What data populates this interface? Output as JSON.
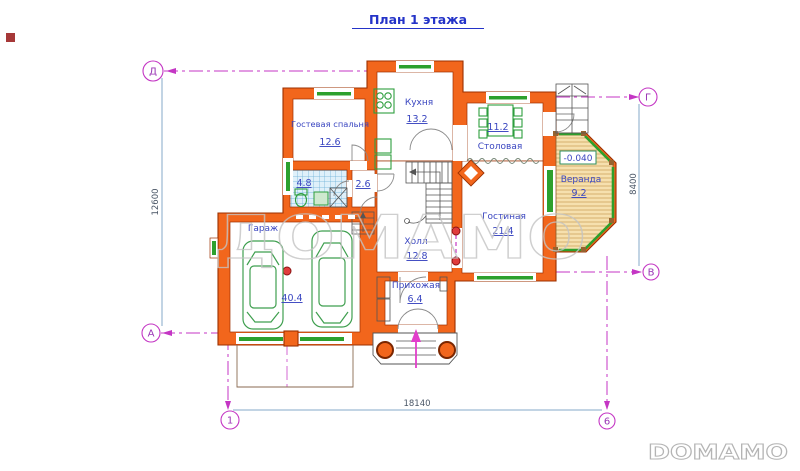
{
  "title": "План 1  этажа",
  "rooms": {
    "bedroom": {
      "name": "Гостевая спальня",
      "area": "12.6"
    },
    "kitchen": {
      "name": "Кухня",
      "area": "13.2"
    },
    "dining": {
      "name": "Столовая",
      "area": "11.2"
    },
    "veranda": {
      "name": "Веранда",
      "area": "9.2",
      "level": "-0.040"
    },
    "living": {
      "name": "Гостиная",
      "area": "21.4"
    },
    "hall": {
      "name": "Холл",
      "area": "12.8"
    },
    "entry": {
      "name": "Прихожая",
      "area": "6.4"
    },
    "garage": {
      "name": "Гараж",
      "area": "40.4"
    },
    "bathroom": {
      "area": "4.8"
    },
    "closet": {
      "area": "2.6"
    }
  },
  "dimensions": {
    "left": "12600",
    "right": "8400",
    "bottom": "18140"
  },
  "axes": {
    "top_left": "Д",
    "top_right": "Г",
    "left_bottom": "А",
    "right_bottom": "В",
    "col_left": "1",
    "col_right": "6"
  },
  "watermark": "ДОМАМО",
  "logo": "DOMAMO",
  "colors": {
    "wall_fill": "#f2661c",
    "wall_outline": "#9c3000",
    "window_green": "#2da02d",
    "label_blue": "#3a46c0",
    "axis_magenta": "#c436c4",
    "dimension_blue": "#85aac8",
    "column_red": "#e03c3c"
  }
}
